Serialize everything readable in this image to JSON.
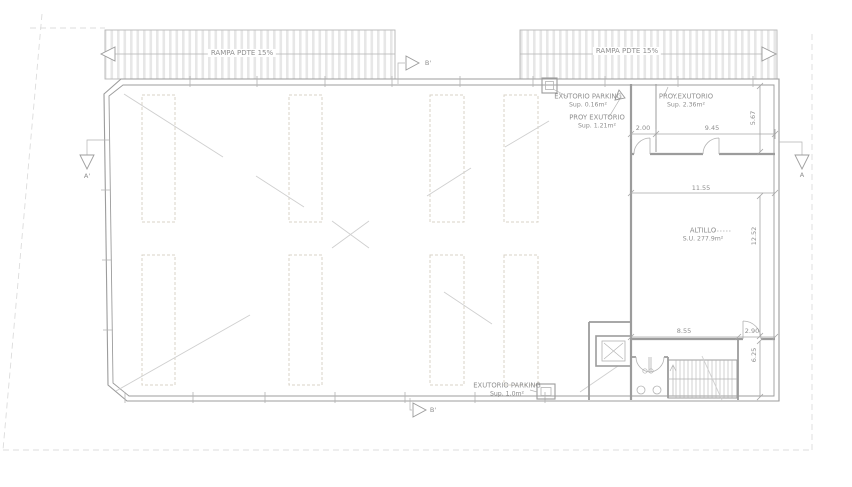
{
  "drawing_title": "parking-floor-plan",
  "colors": {
    "paper": "#ffffff",
    "line_wall": "#9c9c9c",
    "line_thin": "#b3b3b3",
    "line_dim": "#a6a6a6",
    "line_diag": "#cfcfcf",
    "line_site": "#dcdcdc",
    "parking_outline": "#d9d3c7",
    "hatch_fill": "#e7e7e7",
    "hatch_border": "#b7b7b7",
    "text": "#8f8f8f"
  },
  "ramp": {
    "left_label": "RAMPA PDTE 15%",
    "right_label": "RAMPA PDTE 15%"
  },
  "labels": {
    "exutorio_parking_top": {
      "line1": "EXUTORIO PARKING",
      "line2": "Sup. 0.16m²"
    },
    "proy_exutorio_parking": {
      "line1": "PROY EXUTORIO",
      "line2": "Sup. 1.21m²"
    },
    "proy_exutorio_room": {
      "line1": "PROY.EXUTORIO",
      "line2": "Sup. 2.36m²"
    },
    "altillo": {
      "line1": "ALTILLO",
      "line2": "S.U. 277.9m²"
    },
    "exutorio_parking_bottom": {
      "line1": "EXUTORIO PARKING",
      "line2": "Sup. 1.0m²"
    }
  },
  "dimensions": {
    "corridor_width": "2.00",
    "room_width": "9.45",
    "room_height": "5.67",
    "altillo_width": "11.55",
    "altillo_height": "12.52",
    "stair_zone_width": "8.55",
    "right_room_width": "2.90",
    "stair_zone_height": "6.25"
  },
  "section_markers": {
    "a_left": "A'",
    "a_right": "A",
    "b_top": "B'",
    "b_bottom": "B'"
  }
}
